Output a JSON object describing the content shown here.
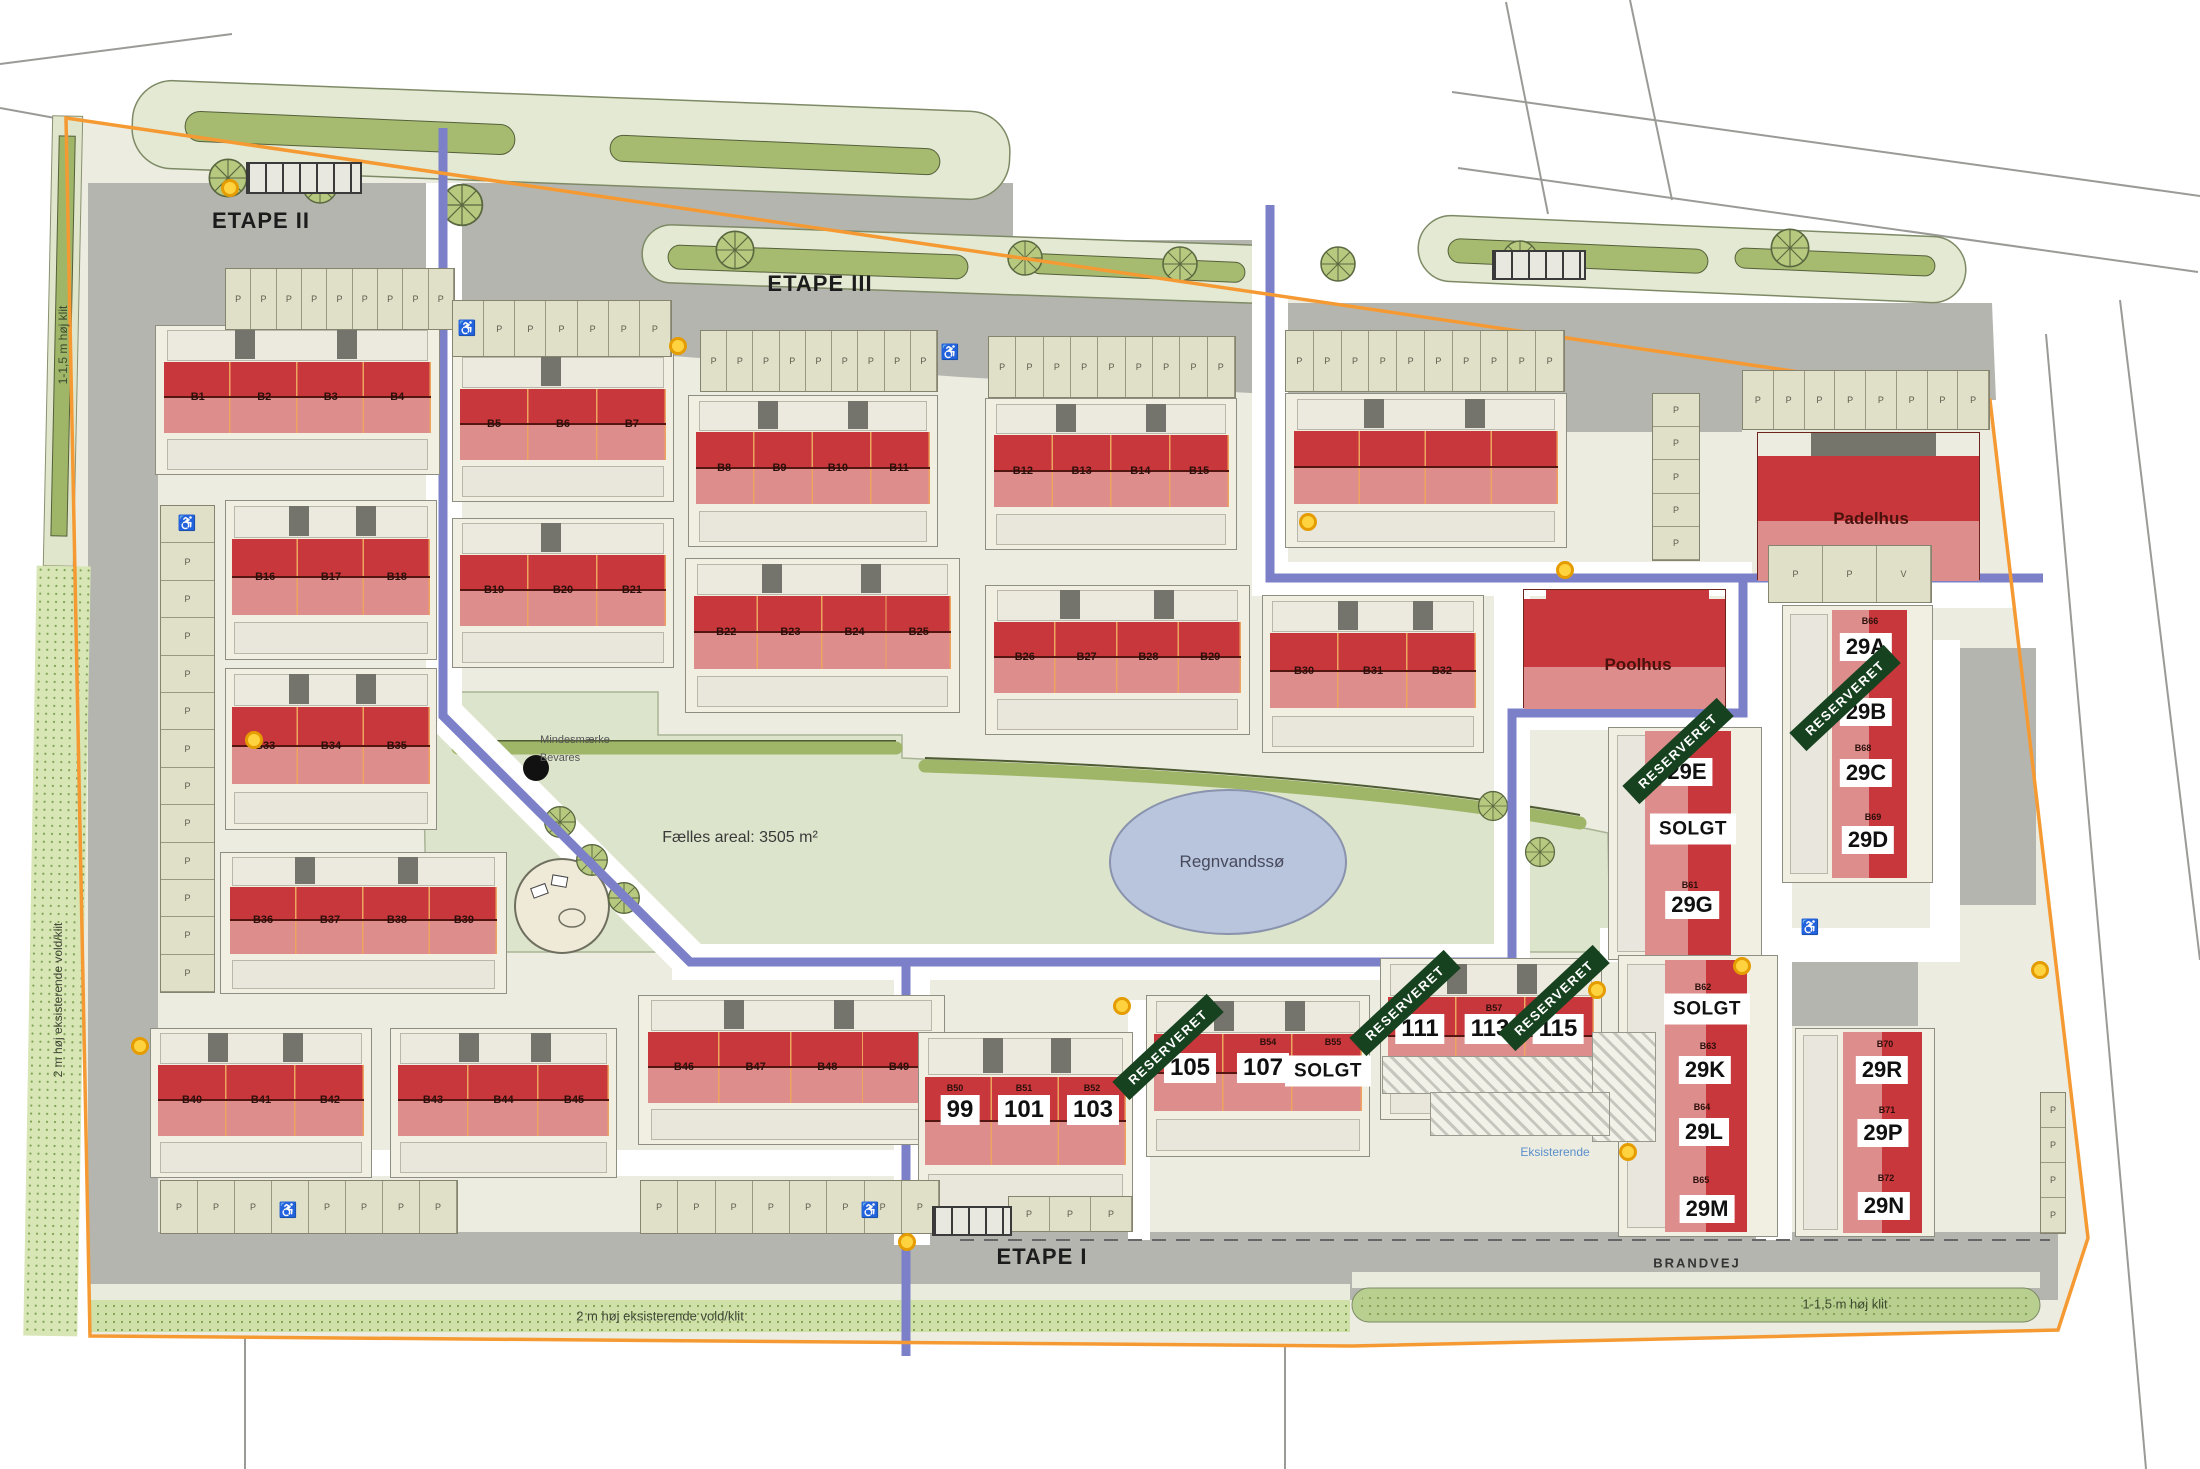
{
  "phase_labels": {
    "etape_i": "ETAPE I",
    "etape_ii": "ETAPE II",
    "etape_iii": "ETAPE III"
  },
  "road_labels": {
    "brandvej": "BRANDVEJ"
  },
  "place_labels": {
    "padelhus": "Padelhus",
    "poolhus": "Poolhus",
    "pond": "Regnvandssø",
    "common_area": "Fælles areal: 3505 m²",
    "memorial_line1": "Mindesmærke",
    "memorial_line2": "Bevares",
    "existing": "Eksisterende",
    "dune_left_top": "1-1,5 m høj klit",
    "dune_left_bottom": "2 m høj eksisterende vold/klit",
    "dune_bottom": "2 m høj eksisterende vold/klit",
    "dune_bottom_right": "1-1,5 m høj klit"
  },
  "status_labels": {
    "reserved": "RESERVERET",
    "sold": "SOLGT"
  },
  "parking_labels": {
    "p": "P",
    "v": "V",
    "handicap": "♿"
  },
  "blocks": {
    "b1_4": [
      "B1",
      "B2",
      "B3",
      "B4"
    ],
    "b5_7": [
      "B5",
      "B6",
      "B7"
    ],
    "b8_11": [
      "B8",
      "B9",
      "B10",
      "B11"
    ],
    "b12_15": [
      "B12",
      "B13",
      "B14",
      "B15"
    ],
    "b16_18": [
      "B16",
      "B17",
      "B18"
    ],
    "b19_21": [
      "B19",
      "B20",
      "B21"
    ],
    "b22_25": [
      "B22",
      "B23",
      "B24",
      "B25"
    ],
    "b26_29": [
      "B26",
      "B27",
      "B28",
      "B29"
    ],
    "b30_32": [
      "B30",
      "B31",
      "B32"
    ],
    "b33_35": [
      "B33",
      "B34",
      "B35"
    ],
    "b36_39": [
      "B36",
      "B37",
      "B38",
      "B39"
    ],
    "b40_42": [
      "B40",
      "B41",
      "B42"
    ],
    "b43_45": [
      "B43",
      "B44",
      "B45"
    ],
    "b46_49": [
      "B46",
      "B47",
      "B48",
      "B49"
    ]
  },
  "sale_rows": {
    "row_99": {
      "plots": [
        "B50",
        "B51",
        "B52"
      ],
      "badges": [
        "99",
        "101",
        "103"
      ]
    },
    "row_105": {
      "plots": [
        "B54",
        "B55"
      ],
      "badges": [
        "105",
        "107"
      ]
    },
    "row_111": {
      "plots": [
        "B57"
      ],
      "badges": [
        "111",
        "113",
        "115"
      ]
    }
  },
  "sale_columns": {
    "col_29a": {
      "plots": [
        "B66",
        "B68",
        "B69"
      ],
      "badges": [
        "29A",
        "29B",
        "29C",
        "29D"
      ]
    },
    "col_29e": {
      "plots": [
        "B61"
      ],
      "badges": [
        "29E",
        "29G"
      ]
    },
    "col_29k": {
      "plots": [
        "B62",
        "B63",
        "B64",
        "B65"
      ],
      "badges": [
        "29K",
        "29L",
        "29M"
      ]
    },
    "col_29r": {
      "plots": [
        "B70",
        "B71",
        "B72"
      ],
      "badges": [
        "29R",
        "29P",
        "29N"
      ]
    }
  },
  "colors": {
    "boundary_orange": "#f59a33",
    "phase_divider_blue": "#7b80c8",
    "reserved_green": "#17421f",
    "house_dark_red": "#c8373b",
    "house_light_red": "#de8d8d",
    "pond_blue": "#b9c4dd",
    "road_gray": "#b5b5b0",
    "dune_green": "#cfe0a8"
  }
}
